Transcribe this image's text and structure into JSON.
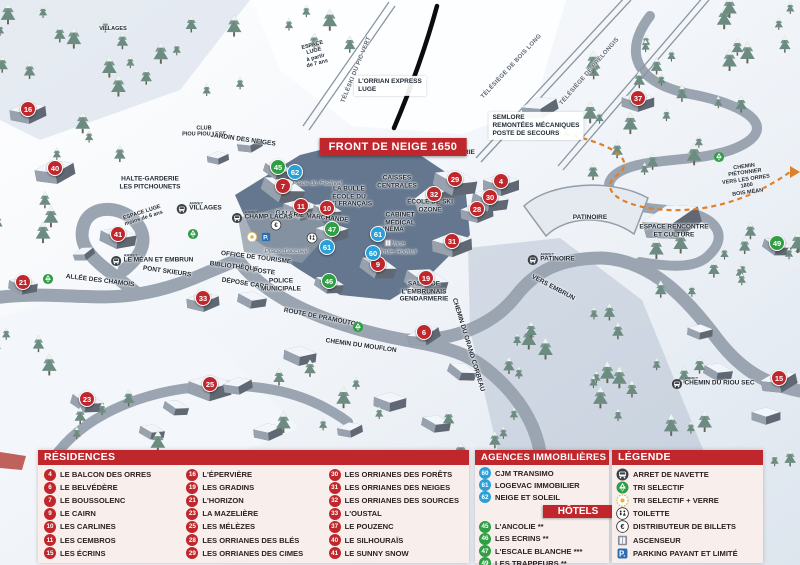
{
  "colors": {
    "accent_red": "#c0272d",
    "marker_blue": "#2aa0d8",
    "marker_green": "#2f9e44",
    "path_orange": "#e07f28"
  },
  "map": {
    "banner": "FRONT DE NEIGE 1650",
    "arret_prefix": "ARRET",
    "markers": [
      {
        "id": "16",
        "color": "red",
        "x": 28,
        "y": 109
      },
      {
        "id": "40",
        "color": "red",
        "x": 55,
        "y": 168
      },
      {
        "id": "41",
        "color": "red",
        "x": 118,
        "y": 234
      },
      {
        "id": "21",
        "color": "red",
        "x": 23,
        "y": 282
      },
      {
        "id": "23",
        "color": "red",
        "x": 87,
        "y": 399
      },
      {
        "id": "25",
        "color": "red",
        "x": 210,
        "y": 384
      },
      {
        "id": "33",
        "color": "red",
        "x": 203,
        "y": 298
      },
      {
        "id": "7",
        "color": "red",
        "x": 283,
        "y": 186
      },
      {
        "id": "11",
        "color": "red",
        "x": 301,
        "y": 206
      },
      {
        "id": "10",
        "color": "red",
        "x": 327,
        "y": 208
      },
      {
        "id": "9",
        "color": "red",
        "x": 378,
        "y": 264
      },
      {
        "id": "19",
        "color": "red",
        "x": 426,
        "y": 278
      },
      {
        "id": "6",
        "color": "red",
        "x": 424,
        "y": 332
      },
      {
        "id": "31",
        "color": "red",
        "x": 452,
        "y": 241
      },
      {
        "id": "28",
        "color": "red",
        "x": 477,
        "y": 209
      },
      {
        "id": "30",
        "color": "red",
        "x": 490,
        "y": 197
      },
      {
        "id": "32",
        "color": "red",
        "x": 434,
        "y": 194
      },
      {
        "id": "29",
        "color": "red",
        "x": 455,
        "y": 179
      },
      {
        "id": "4",
        "color": "red",
        "x": 501,
        "y": 181
      },
      {
        "id": "37",
        "color": "red",
        "x": 638,
        "y": 98
      },
      {
        "id": "15",
        "color": "red",
        "x": 779,
        "y": 378
      },
      {
        "id": "45",
        "color": "green",
        "x": 278,
        "y": 167
      },
      {
        "id": "47",
        "color": "green",
        "x": 332,
        "y": 229
      },
      {
        "id": "46",
        "color": "green",
        "x": 329,
        "y": 281
      },
      {
        "id": "49",
        "color": "green",
        "x": 777,
        "y": 243
      },
      {
        "id": "62",
        "color": "blue",
        "x": 295,
        "y": 172
      },
      {
        "id": "61",
        "color": "blue",
        "x": 327,
        "y": 247
      },
      {
        "id": "61",
        "color": "blue",
        "x": 378,
        "y": 234
      },
      {
        "id": "60",
        "color": "blue",
        "x": 373,
        "y": 253
      }
    ],
    "labels": [
      {
        "text": "L'ORRIAN EXPRESS\nLUGE",
        "x": 390,
        "y": 86,
        "style": "box"
      },
      {
        "text": "TÉLÉSKI DU PIC VERT",
        "x": 357,
        "y": 70,
        "rot": -68,
        "style": "lift"
      },
      {
        "text": "TÉLÉSIÈGE DE BOIS LONG",
        "x": 512,
        "y": 67,
        "rot": -47,
        "style": "lift"
      },
      {
        "text": "TÉLÉSIÈGE DE PRÉLONGIS",
        "x": 590,
        "y": 72,
        "rot": -49,
        "style": "lift"
      },
      {
        "text": "SEMLORE\nREMONTÉES MÉCANIQUES\nPOSTE DE SECOURS",
        "x": 536,
        "y": 126,
        "style": "box"
      },
      {
        "text": "LAVERIE",
        "x": 461,
        "y": 153
      },
      {
        "text": "CAISSES\nCENTRALES",
        "x": 397,
        "y": 182
      },
      {
        "text": "LA BULLE\nÉCOLE DU\nSKI FRANÇAIS",
        "x": 349,
        "y": 197
      },
      {
        "text": "Place du Festival",
        "x": 317,
        "y": 184,
        "style": "place"
      },
      {
        "text": "ÉCOLE DE SKI\nOZONE",
        "x": 430,
        "y": 206
      },
      {
        "text": "CABINET\nMÉDICAL",
        "x": 400,
        "y": 219
      },
      {
        "text": "CINÉMA",
        "x": 391,
        "y": 230
      },
      {
        "text": "Place\nÉmile Hodoul",
        "x": 397,
        "y": 248,
        "style": "place"
      },
      {
        "text": "Place d'accueil",
        "x": 286,
        "y": 252,
        "style": "place"
      },
      {
        "text": "GALERIE MARCHANDE",
        "x": 312,
        "y": 217,
        "rot": 6
      },
      {
        "text": "SALLE DE\nL'EMBRUNAIS\nGENDARMERIE",
        "x": 424,
        "y": 292
      },
      {
        "text": "PATINOIRE",
        "x": 590,
        "y": 218
      },
      {
        "text": "ESPACE RENCONTRE\nET CULTURE",
        "x": 674,
        "y": 231
      },
      {
        "text": "ALLÉE DES CHAMOIS",
        "x": 100,
        "y": 281,
        "rot": 7
      },
      {
        "text": "PONT SKIEURS",
        "x": 167,
        "y": 272,
        "rot": 8
      },
      {
        "text": "ROUTE DE PRAMOUTON",
        "x": 322,
        "y": 318,
        "rot": 11
      },
      {
        "text": "CHEMIN DU MOUFLON",
        "x": 361,
        "y": 346,
        "rot": 8
      },
      {
        "text": "CHEMIN DU GRAND CORBEAU",
        "x": 468,
        "y": 345,
        "rot": 73
      },
      {
        "text": "VERS EMBRUN",
        "x": 553,
        "y": 288,
        "rot": 28
      },
      {
        "text": "HALTE-GARDERIE\nLES PITCHOUNETS",
        "x": 150,
        "y": 183
      },
      {
        "text": "ESPACE LUGE\nmoins de 6 ans",
        "x": 143,
        "y": 216,
        "rot": -18,
        "style": "tiny"
      },
      {
        "text": "ESPACE\nLUGE\nà partir\nde 7 ans",
        "x": 315,
        "y": 55,
        "rot": -15,
        "style": "tiny"
      },
      {
        "text": "CLUB\nPIOU PIOU / ESF",
        "x": 204,
        "y": 132,
        "style": "tiny"
      },
      {
        "text": "JARDIN DES NEIGES",
        "x": 243,
        "y": 140,
        "rot": 8
      },
      {
        "text": "OFFICE DE TOURISME",
        "x": 256,
        "y": 258,
        "rot": 7
      },
      {
        "text": "BIBLIOTHÈQUE",
        "x": 234,
        "y": 267,
        "rot": 7
      },
      {
        "text": "POSTE",
        "x": 264,
        "y": 272,
        "rot": 7
      },
      {
        "text": "DÉPOSE CARS",
        "x": 245,
        "y": 284,
        "rot": 9
      },
      {
        "text": "POLICE\nMUNICIPALE",
        "x": 281,
        "y": 285
      },
      {
        "text": "CHEMIN PIÉTONNIER\nVERS LES ORRES 1800\nBOIS MÉAN",
        "x": 746,
        "y": 180,
        "rot": -8,
        "style": "tiny"
      },
      {
        "text": "VILLAGES",
        "x": 113,
        "y": 29,
        "style": "tiny"
      }
    ],
    "arrets": [
      {
        "name": "VILLAGES",
        "x": 199,
        "y": 207
      },
      {
        "name": "CHAMP LACAS",
        "x": 262,
        "y": 216
      },
      {
        "name": "LE MÉAN ET EMBRUN",
        "x": 152,
        "y": 259
      },
      {
        "name": "PATINOIRE",
        "x": 551,
        "y": 258
      },
      {
        "name": "CHEMIN DU RIOU SEC",
        "x": 713,
        "y": 382
      }
    ],
    "icons": [
      {
        "type": "parking-icon",
        "x": 266,
        "y": 237
      },
      {
        "type": "recycle-glass-icon",
        "x": 252,
        "y": 237
      },
      {
        "type": "atm-icon",
        "x": 276,
        "y": 225
      },
      {
        "type": "recycle-icon",
        "x": 193,
        "y": 234
      },
      {
        "type": "recycle-icon",
        "x": 48,
        "y": 279
      },
      {
        "type": "recycle-icon",
        "x": 358,
        "y": 327
      },
      {
        "type": "recycle-icon",
        "x": 719,
        "y": 157
      },
      {
        "type": "toilet-icon",
        "x": 312,
        "y": 238
      },
      {
        "type": "elevator-icon",
        "x": 388,
        "y": 243
      }
    ]
  },
  "legend": {
    "residences": {
      "title": "RÉSIDENCES",
      "items": [
        {
          "id": "4",
          "label": "LE BALCON DES ORRES"
        },
        {
          "id": "6",
          "label": "LE BELVÉDÈRE"
        },
        {
          "id": "7",
          "label": "LE BOUSSOLENC"
        },
        {
          "id": "9",
          "label": "LE CAIRN"
        },
        {
          "id": "10",
          "label": "LES CARLINES"
        },
        {
          "id": "11",
          "label": "LES CEMBROS"
        },
        {
          "id": "15",
          "label": "LES ÉCRINS"
        },
        {
          "id": "16",
          "label": "L'ÉPERVIÈRE"
        },
        {
          "id": "19",
          "label": "LES GRADINS"
        },
        {
          "id": "21",
          "label": "L'HORIZON"
        },
        {
          "id": "23",
          "label": "LA MAZELIÈRE"
        },
        {
          "id": "25",
          "label": "LES MÉLÈZES"
        },
        {
          "id": "28",
          "label": "LES ORRIANES DES BLÉS"
        },
        {
          "id": "29",
          "label": "LES ORRIANES DES CIMES"
        },
        {
          "id": "30",
          "label": "LES ORRIANES DES FORÊTS"
        },
        {
          "id": "31",
          "label": "LES ORRIANES DES NEIGES"
        },
        {
          "id": "32",
          "label": "LES ORRIANES DES SOURCES"
        },
        {
          "id": "33",
          "label": "L'OUSTAL"
        },
        {
          "id": "37",
          "label": "LE POUZENC"
        },
        {
          "id": "40",
          "label": "LE SILHOURAÏS"
        },
        {
          "id": "41",
          "label": "LE SUNNY SNOW"
        }
      ]
    },
    "agences": {
      "title": "AGENCES IMMOBILIÈRES",
      "items": [
        {
          "id": "60",
          "label": "CJM TRANSIMO"
        },
        {
          "id": "61",
          "label": "LOGEVAC IMMOBILIER"
        },
        {
          "id": "62",
          "label": "NEIGE ET SOLEIL"
        }
      ]
    },
    "hotels": {
      "title": "HÔTELS",
      "items": [
        {
          "id": "45",
          "label": "L'ANCOLIE **"
        },
        {
          "id": "46",
          "label": "LES ECRINS **"
        },
        {
          "id": "47",
          "label": "L'ESCALE BLANCHE ***"
        },
        {
          "id": "49",
          "label": "LES TRAPPEURS **"
        }
      ]
    },
    "legende": {
      "title": "LÉGENDE",
      "items": [
        {
          "icon": "bus-icon",
          "label": "ARRET DE NAVETTE"
        },
        {
          "icon": "recycle-icon",
          "label": "TRI SELECTIF"
        },
        {
          "icon": "recycle-glass-icon",
          "label": "TRI SELECTIF + VERRE"
        },
        {
          "icon": "toilet-icon",
          "label": "TOILETTE"
        },
        {
          "icon": "atm-icon",
          "label": "DISTRIBUTEUR DE BILLETS"
        },
        {
          "icon": "elevator-icon",
          "label": "ASCENSEUR"
        },
        {
          "icon": "parking-icon",
          "label": "PARKING PAYANT ET LIMITÉ"
        }
      ]
    }
  }
}
